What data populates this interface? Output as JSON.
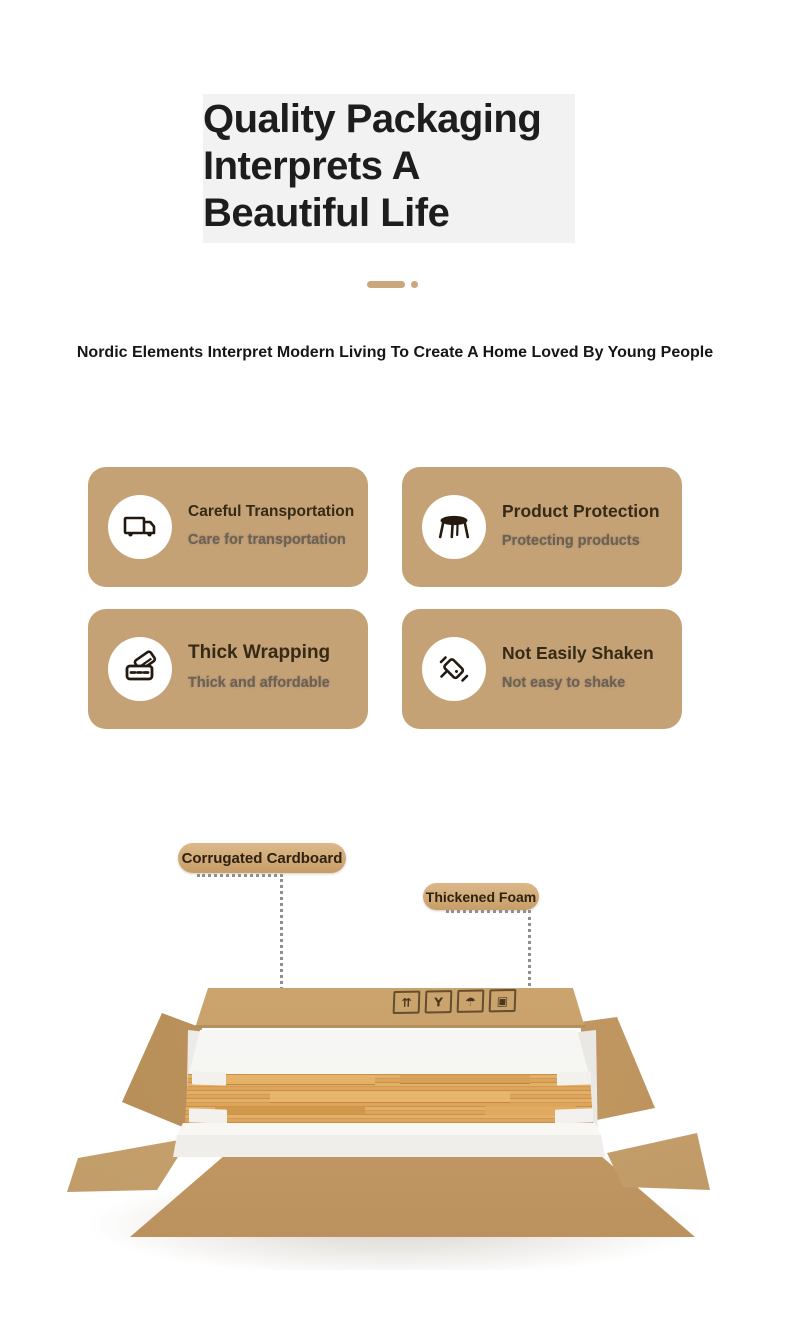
{
  "page": {
    "background": "#ffffff"
  },
  "header": {
    "title": "Quality Packaging\nInterprets A\nBeautiful Life",
    "divider_color": "#C9A97C",
    "subtitle": "Nordic Elements Interpret Modern Living To Create A Home Loved By Young People"
  },
  "features": {
    "card_background": "#C5A176",
    "cards": [
      {
        "icon": "truck-icon",
        "title": "Careful Transportation",
        "subtitle": "Care for transportation"
      },
      {
        "icon": "round-table-icon",
        "title": "Product Protection",
        "subtitle": "Protecting products"
      },
      {
        "icon": "wrapping-wallet-icon",
        "title": "Thick Wrapping",
        "subtitle": "Thick and affordable"
      },
      {
        "icon": "shake-phone-icon",
        "title": "Not Easily Shaken",
        "subtitle": "Not easy to shake"
      }
    ]
  },
  "packaging_diagram": {
    "labels": [
      {
        "text": "Corrugated Cardboard"
      },
      {
        "text": "Thickened Foam"
      }
    ],
    "carton_symbols": [
      {
        "name": "this-way-up-symbol",
        "glyph": "⇈"
      },
      {
        "name": "fragile-symbol",
        "glyph": "Y"
      },
      {
        "name": "keep-dry-symbol",
        "glyph": "☂"
      },
      {
        "name": "package-symbol",
        "glyph": "▣"
      }
    ],
    "colors": {
      "cardboard": "#C6A06C",
      "wood": "#D79E54",
      "foam": "#F5F4F1",
      "accent_tan": "#C9A97C"
    }
  }
}
